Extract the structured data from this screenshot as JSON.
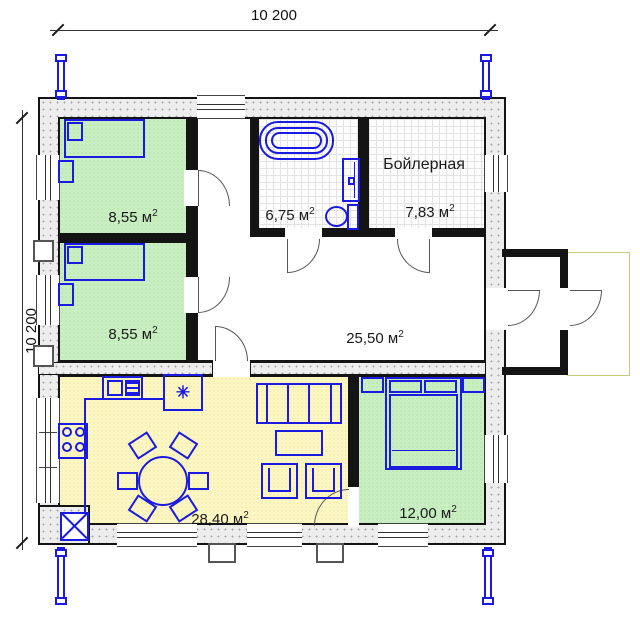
{
  "plan": {
    "dimensions": {
      "top": "10 200",
      "left": "10 200"
    },
    "rooms": {
      "bedroom1": {
        "area": "8,55 м",
        "sup": "2"
      },
      "bedroom2": {
        "area": "8,55 м",
        "sup": "2"
      },
      "bathroom": {
        "area": "6,75 м",
        "sup": "2"
      },
      "boiler": {
        "name": "Бойлерная",
        "area": "7,83 м",
        "sup": "2"
      },
      "hall": {
        "area": "25,50 м",
        "sup": "2"
      },
      "living": {
        "area": "28,40 м",
        "sup": "2"
      },
      "bedroom3": {
        "area": "12,00 м",
        "sup": "2"
      }
    },
    "icons": {
      "fridge": "✳"
    }
  },
  "colors": {
    "wall": "#141414",
    "furniture": "#1a1ae0",
    "bedroom-floor": "#c9eec2",
    "living-floor": "#fcf7c2",
    "tile-floor": "#fdfdfd",
    "porch": "#c9c97e"
  }
}
